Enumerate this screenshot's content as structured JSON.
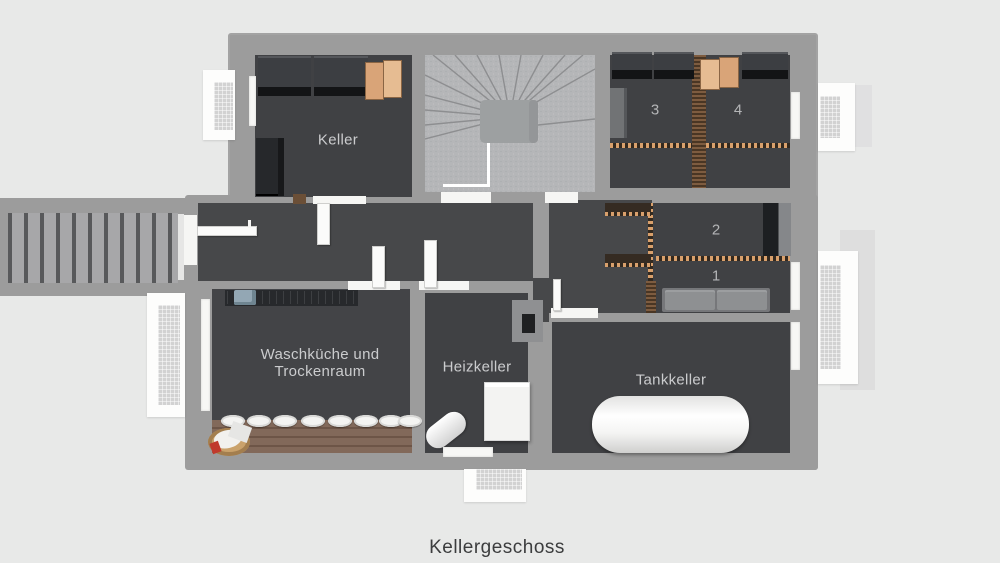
{
  "caption": "Kellergeschoss",
  "rooms": {
    "keller": "Keller",
    "waschkueche_line1": "Waschküche und",
    "waschkueche_line2": "Trockenraum",
    "heizkeller": "Heizkeller",
    "tankkeller": "Tankkeller"
  },
  "compartments": {
    "c1": "1",
    "c2": "2",
    "c3": "3",
    "c4": "4"
  },
  "colors": {
    "background": "#e8e9e8",
    "wall": "#9c9c9c",
    "floor_dark": "#404144",
    "floor_hall": "#47484a",
    "stair_concrete": "#b5b6b8",
    "wood_partition": "#7e5c40",
    "wood_dot_accent": "#d9a06c",
    "counter_wood": "#7f6a5d",
    "storage_box_orange": "#ddab7f",
    "cabinet_dark": "#26282b",
    "white_fixture": "#f6f6f4",
    "room_label_text": "#cbccce",
    "caption_text": "#3c3d3e"
  }
}
